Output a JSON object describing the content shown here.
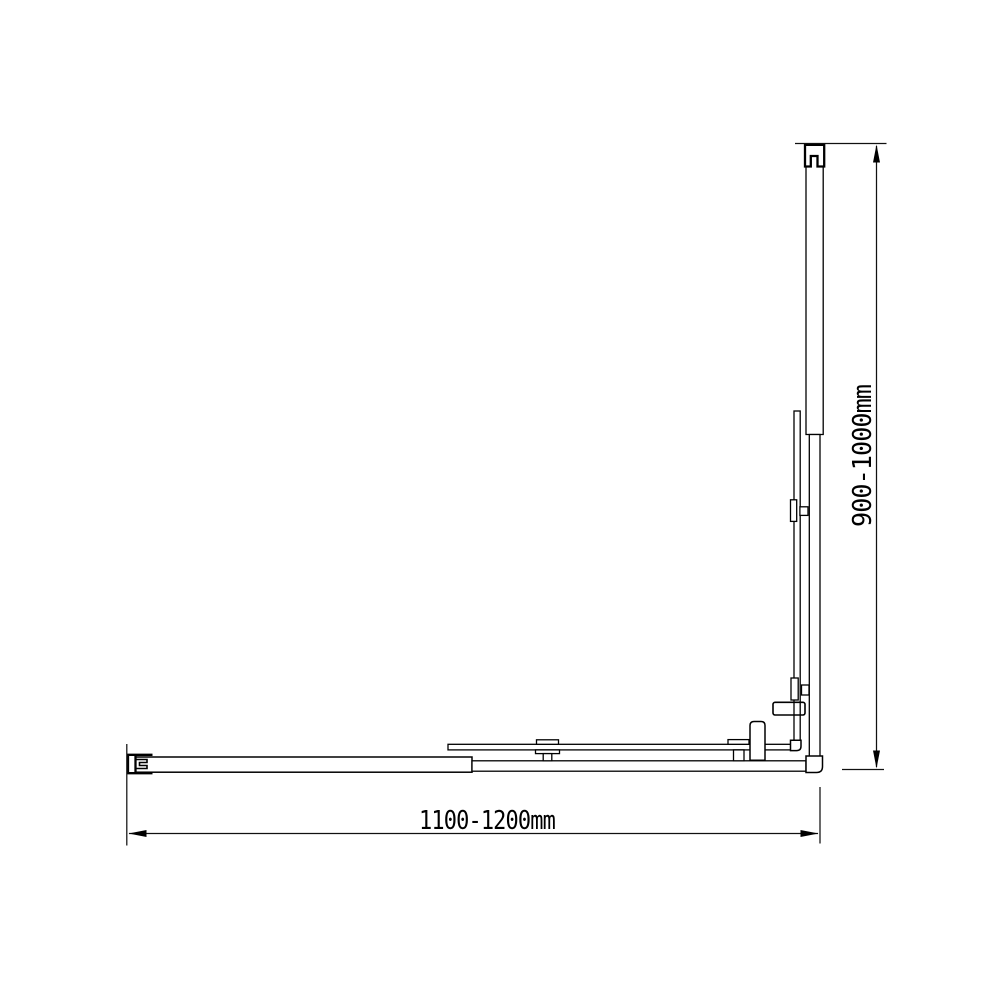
{
  "page": {
    "background_color": "#ffffff",
    "line_color": "#000000"
  },
  "drawing": {
    "kind": "shower-screen-dimension-diagram",
    "labels": {
      "width": "1100-1200mm",
      "height": "900-1000mm"
    }
  }
}
